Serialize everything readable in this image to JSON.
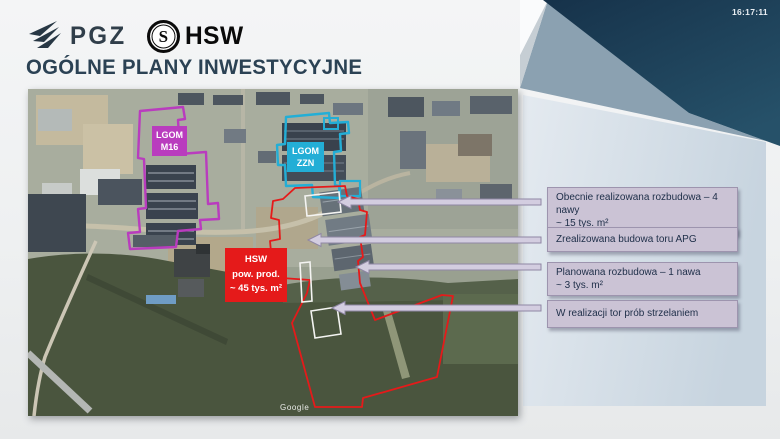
{
  "header": {
    "pgz_label": "PGZ",
    "hsw_label": "HSW",
    "hsw_monogram": "S",
    "timestamp": "16:17:11"
  },
  "title": "OGÓLNE PLANY INWESTYCYJNE",
  "map": {
    "attribution": "Google",
    "areas": {
      "m16": {
        "line1": "LGOM",
        "line2": "M16",
        "color": "#b93cbe"
      },
      "zzn": {
        "line1": "LGOM",
        "line2": "ZZN",
        "color": "#23aed6"
      },
      "hsw": {
        "line1": "HSW",
        "line2": "pow. prod.",
        "line3": "~ 45 tys. m²",
        "color": "#e51a1a"
      }
    }
  },
  "callouts": [
    {
      "line1": "Obecnie realizowana rozbudowa – 4 nawy",
      "line2": "~ 15 tys. m²"
    },
    {
      "line1": "Zrealizowana budowa toru APG",
      "line2": ""
    },
    {
      "line1": "Planowana rozbudowa – 1 nawa",
      "line2": "~ 3 tys. m²"
    },
    {
      "line1": "W realizacji  tor prób strzelaniem",
      "line2": ""
    }
  ],
  "colors": {
    "navy_corner": "#1a3850",
    "side_panel": "#d7e0e9",
    "callout_bg": "#cbc3d5",
    "callout_border": "#9d94ae",
    "arrow_fill": "#d3cde0",
    "title_text": "#2b4254",
    "area_magenta": "#b93cbe",
    "area_cyan": "#23aed6",
    "area_red": "#e51a1a"
  }
}
